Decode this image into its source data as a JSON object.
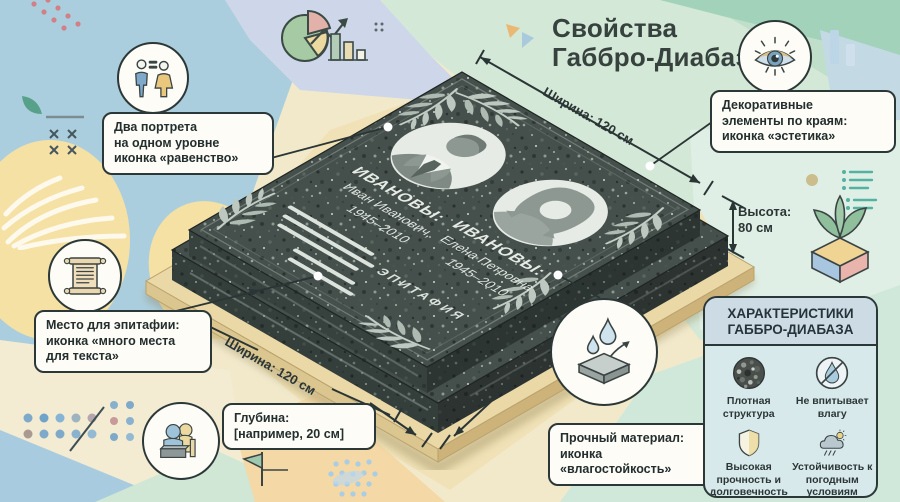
{
  "title": {
    "line1": "Свойства",
    "line2": "Габбро-Диабаз"
  },
  "monument": {
    "left_person": {
      "surname": "ИВАНОВЫ:",
      "name": "Иван Иванович,",
      "years": "1945–2010"
    },
    "right_person": {
      "surname": "ИВАНОВЫ:",
      "name": "Елена Петровна",
      "years": "1945–2010"
    },
    "epitaph": "ЭПИТАФИЯ"
  },
  "dimensions": {
    "width_top": "Ширина: 120 см",
    "width_bottom": "Ширина: 120 см",
    "height_label": "Высота:",
    "height_value": "80 см"
  },
  "callouts": {
    "portraits": {
      "icon": "equality-icon",
      "lines": [
        "Два портрета",
        "на одном уровне",
        "иконка «равенство»"
      ]
    },
    "decor": {
      "icon": "eye-icon",
      "lines": [
        "Декоративные",
        "элементы по краям:",
        "иконка «эстетика»"
      ]
    },
    "epitaph": {
      "icon": "scroll-icon",
      "lines": [
        "Место для эпитафии:",
        "иконка «много места",
        "для текста»"
      ]
    },
    "depth": {
      "icon": "figures-monument-icon",
      "lines": [
        "Глубина:",
        "[например, 20 см]"
      ]
    },
    "material": {
      "icon": "water-drops-slab-icon",
      "lines": [
        "Прочный материал:",
        "иконка",
        "«влагостойкость»"
      ]
    }
  },
  "panel": {
    "title_line1": "ХАРАКТЕРИСТИКИ",
    "title_line2": "ГАББРО-ДИАБАЗА",
    "items": [
      {
        "icon": "dense-structure-icon",
        "label": "Плотная структура"
      },
      {
        "icon": "no-moisture-icon",
        "label": "Не впитывает влагу"
      },
      {
        "icon": "shield-icon",
        "label": "Высокая прочность и долговечность"
      },
      {
        "icon": "weather-icon",
        "label": "Устойчивость к погодным условиям"
      }
    ]
  },
  "colors": {
    "outline_dark": "#2c3838",
    "granite": "#454f4b",
    "mint": "#d4e8d8",
    "sky_blue": "#abcede",
    "sand": "#f2e9cb",
    "platform": "#ead8a6",
    "panel_bg": "#d8e9ec",
    "accent_yellow": "#ecd9a0",
    "accent_pink": "#e2b1a9",
    "accent_green": "#a6cba4"
  }
}
